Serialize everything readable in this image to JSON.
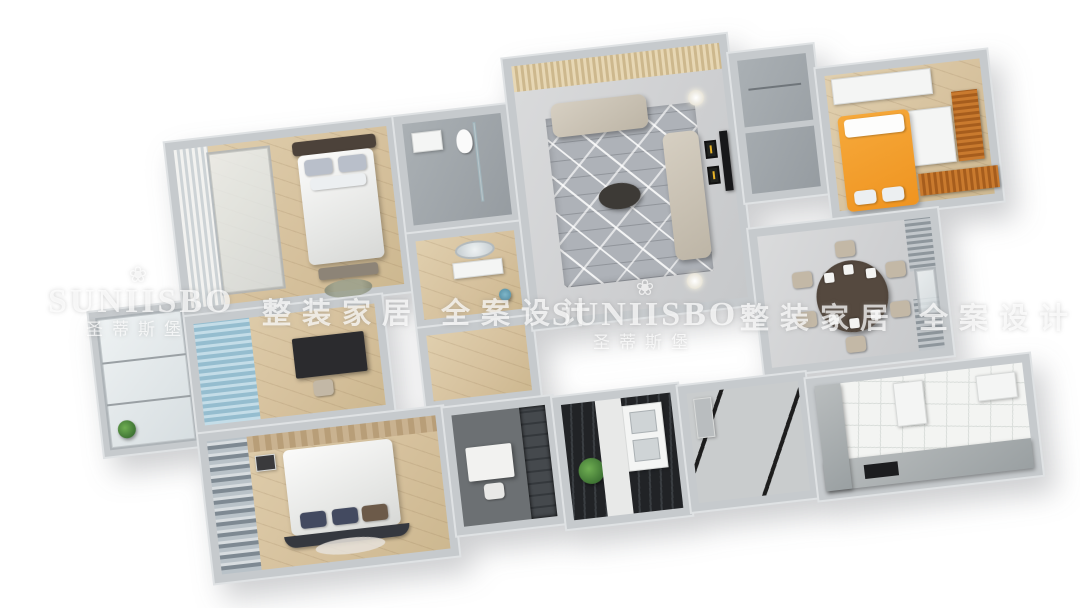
{
  "watermarks": {
    "logo_flower": "❀",
    "brand_en": "SUNIISBO",
    "brand_cn": "圣蒂斯堡",
    "tagline_left": "整装家居 全案设计",
    "tagline_right": "整装家居 全案设计"
  },
  "palette": {
    "background": "#ffffff",
    "wall": "#c6cacd",
    "wood_floor": "#d6c19d",
    "marble_floor": "#cfd0d2",
    "accent_orange": "#ef9420",
    "accent_blue": "#95bdcf",
    "sofa_beige": "#c9c1b2",
    "navy_pillow": "#434a60",
    "deck_dark": "#2a2d30",
    "plant_green": "#4a7c3f",
    "art_yellow": "#e8b428"
  },
  "scene": {
    "type": "3d-rendered-floor-plan",
    "view": "isometric top-down, rotated",
    "rooms": [
      "master-bedroom",
      "bathroom",
      "vanity-washroom",
      "living-room",
      "storage-closets",
      "kids-room-orange",
      "study-blue",
      "left-balcony",
      "dining-room",
      "second-bedroom",
      "study-nook",
      "laundry-balcony",
      "entry-foyer",
      "kitchen"
    ]
  }
}
